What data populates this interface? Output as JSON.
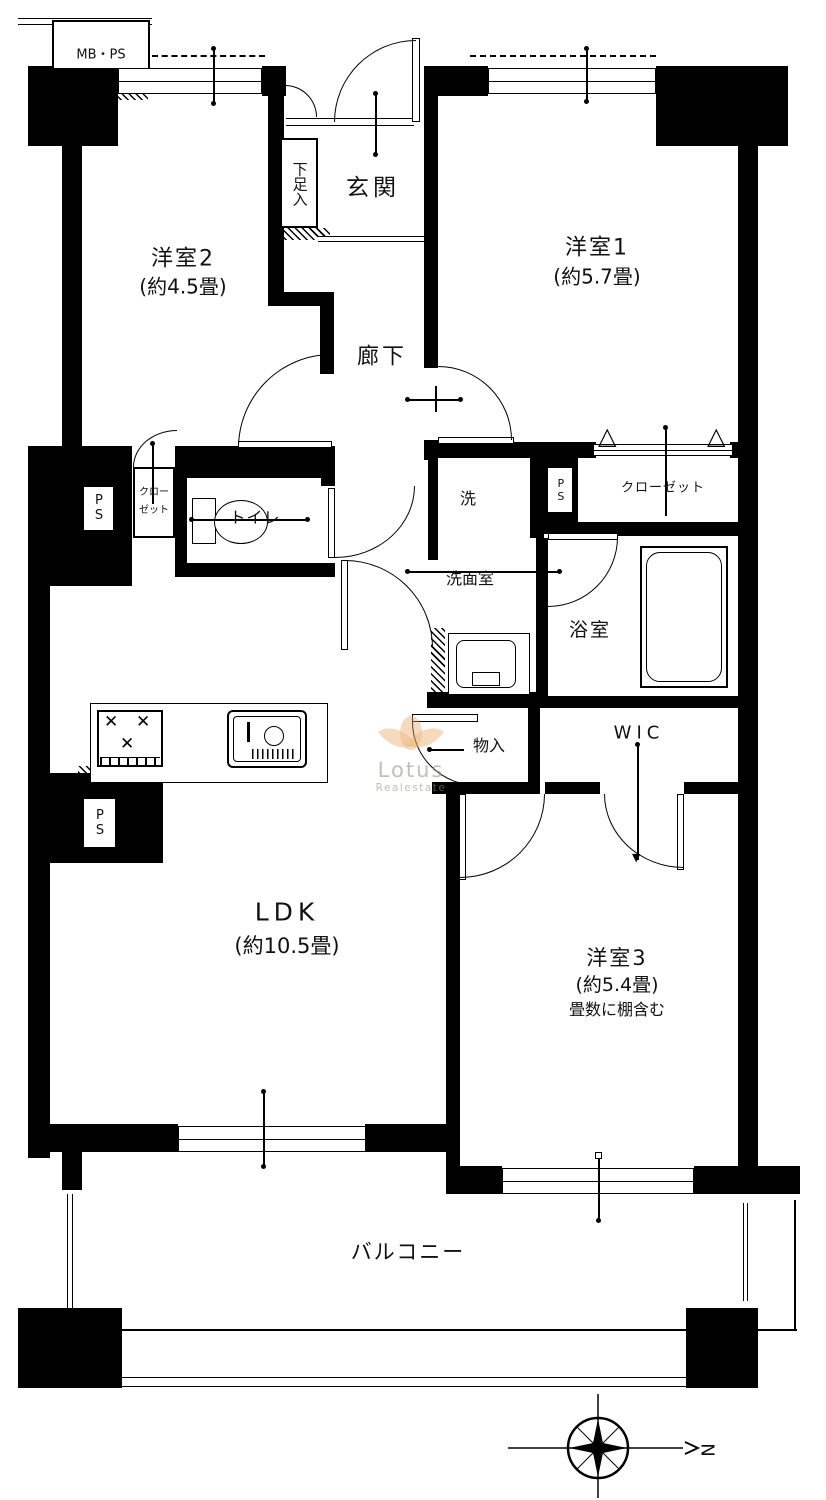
{
  "colors": {
    "wall": "#000000",
    "background": "#ffffff",
    "watermark_logo": "#e8a560",
    "watermark_text": "#a3a196"
  },
  "labels": {
    "mbps": "MB・PS",
    "genkan": "玄関",
    "shoe_storage": "下足入",
    "room2": {
      "name": "洋室2",
      "size": "(約4.5畳)"
    },
    "room1": {
      "name": "洋室1",
      "size": "(約5.7畳)"
    },
    "hallway": "廊下",
    "ps": "PS",
    "closet_small": "クローゼット",
    "toilet": "トイレ",
    "laundry": "洗",
    "closet": "クローゼット",
    "washroom": "洗面室",
    "bathroom": "浴室",
    "storage": "物入",
    "wic": "WIC",
    "ldk": {
      "name": "LDK",
      "size": "(約10.5畳)"
    },
    "room3": {
      "name": "洋室3",
      "size": "(約5.4畳)",
      "note": "畳数に棚含む"
    },
    "balcony": "バルコニー",
    "compass_north": "N",
    "watermark": {
      "brand": "Lotus",
      "sub": "Realestate"
    }
  }
}
